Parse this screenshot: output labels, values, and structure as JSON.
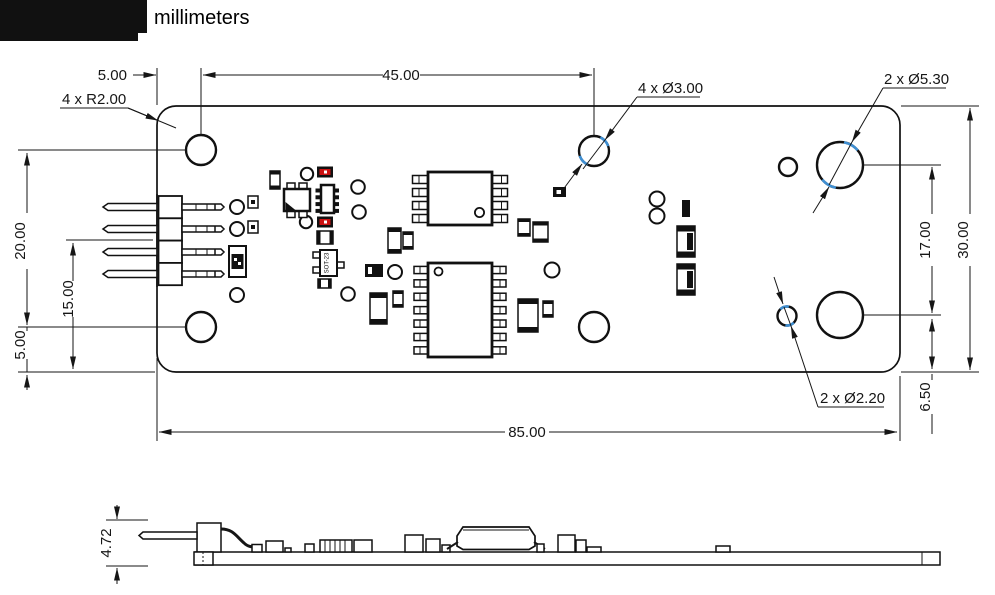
{
  "title": {
    "unit_label": "millimeters"
  },
  "top_view": {
    "dimensions": {
      "edge_to_hole": "5.00",
      "hole_spacing": "45.00",
      "hole_column_spacing": "20.00",
      "pin_row_to_bottom": "15.00",
      "hole_to_bottom_edge": "5.00",
      "right_hole_spacing": "17.00",
      "board_height": "30.00",
      "right_hole_to_edge": "6.50",
      "board_width": "85.00"
    },
    "callouts": {
      "small_holes": "4 x Ø3.00",
      "corner_radius": "4 x R2.00",
      "large_holes": "2 x Ø5.30",
      "tiny_holes": "2 x Ø2.20"
    },
    "component_labels": {
      "sot23": "SOT-23"
    }
  },
  "side_view": {
    "dimensions": {
      "overall_height": "4.72"
    }
  },
  "colors": {
    "callout_highlight": "#3f8fd2",
    "component_red": "#cc1111",
    "line": "#161616"
  }
}
